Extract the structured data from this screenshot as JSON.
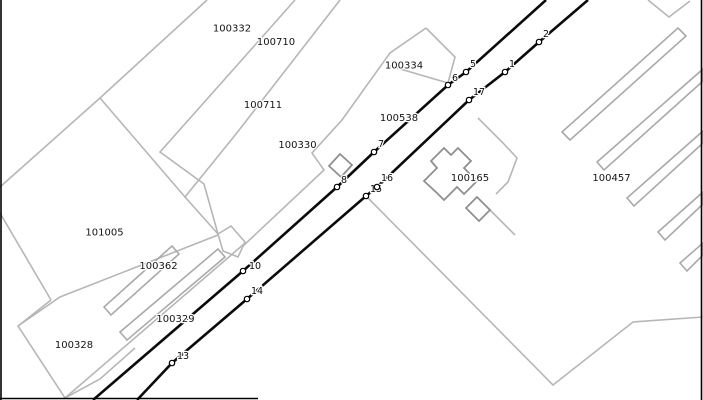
{
  "map": {
    "width": 703,
    "height": 400,
    "colors": {
      "background": "#ffffff",
      "parcel_line": "#b6b6b6",
      "strip_line": "#a9a9a9",
      "building_line": "#8f8f8f",
      "route_line": "#0b0b0b",
      "border": "#000000",
      "label_text": "#141414",
      "station_fill": "#ffffff",
      "station_stroke": "#000000",
      "halo": "#ffffff"
    },
    "parcel_labels": [
      {
        "text": "100332",
        "x": 232,
        "y": 28
      },
      {
        "text": "100710",
        "x": 276,
        "y": 41.5
      },
      {
        "text": "100711",
        "x": 263,
        "y": 104.5
      },
      {
        "text": "100330",
        "x": 297.5,
        "y": 144.5
      },
      {
        "text": "100334",
        "x": 404,
        "y": 65
      },
      {
        "text": "100538",
        "x": 399,
        "y": 117.5
      },
      {
        "text": "100165",
        "x": 470,
        "y": 177.5
      },
      {
        "text": "100457",
        "x": 611.5,
        "y": 177.5
      },
      {
        "text": "101005",
        "x": 104.5,
        "y": 232
      },
      {
        "text": "100362",
        "x": 158.5,
        "y": 265.5
      },
      {
        "text": "100329",
        "x": 175.5,
        "y": 318.5
      },
      {
        "text": "100328",
        "x": 74,
        "y": 344.5
      }
    ],
    "parcel_lines": [
      {
        "points": [
          [
            207,
            0
          ],
          [
            100,
            98
          ],
          [
            0,
            187
          ]
        ]
      },
      {
        "points": [
          [
            100,
            98
          ],
          [
            185,
            197
          ],
          [
            218,
            234
          ]
        ]
      },
      {
        "points": [
          [
            295,
            0
          ],
          [
            160,
            152
          ],
          [
            204,
            184
          ],
          [
            211,
            209
          ],
          [
            218,
            234
          ]
        ]
      },
      {
        "points": [
          [
            340,
            0
          ],
          [
            236,
            134
          ],
          [
            185,
            197
          ]
        ]
      },
      {
        "points": [
          [
            426,
            28
          ],
          [
            390,
            53
          ],
          [
            342,
            120
          ],
          [
            312,
            153
          ],
          [
            324,
            170
          ],
          [
            243,
            246
          ]
        ]
      },
      {
        "points": [
          [
            426,
            28
          ],
          [
            455,
            57
          ],
          [
            448,
            83
          ]
        ]
      },
      {
        "points": [
          [
            390,
            66
          ],
          [
            448,
            83
          ]
        ]
      },
      {
        "points": [
          [
            218,
            234
          ],
          [
            231,
            226
          ],
          [
            245,
            242
          ],
          [
            238,
            257
          ],
          [
            223,
            251
          ],
          [
            218,
            234
          ]
        ]
      },
      {
        "points": [
          [
            244,
            244
          ],
          [
            65,
            398
          ]
        ]
      },
      {
        "points": [
          [
            218,
            235
          ],
          [
            60,
            297
          ],
          [
            18,
            326
          ]
        ]
      },
      {
        "points": [
          [
            51,
            300
          ],
          [
            18,
            326
          ],
          [
            65,
            398
          ],
          [
            100,
            379
          ],
          [
            135,
            348
          ]
        ]
      },
      {
        "points": [
          [
            0,
            213
          ],
          [
            51,
            300
          ]
        ]
      },
      {
        "points": [
          [
            368,
            198
          ],
          [
            553,
            385
          ],
          [
            633,
            322
          ],
          [
            703,
            317
          ]
        ]
      },
      {
        "points": [
          [
            478,
            118
          ],
          [
            503,
            143
          ],
          [
            517,
            158
          ],
          [
            508,
            182
          ],
          [
            496,
            194
          ]
        ]
      },
      {
        "points": [
          [
            490,
            210
          ],
          [
            515,
            235
          ]
        ]
      },
      {
        "points": [
          [
            648,
            0
          ],
          [
            669,
            17
          ],
          [
            690,
            1
          ]
        ]
      }
    ],
    "strip_polygons": [
      {
        "points": [
          [
            562,
            132
          ],
          [
            678,
            28
          ],
          [
            686,
            36
          ],
          [
            570,
            140
          ]
        ]
      },
      {
        "points": [
          [
            597,
            162
          ],
          [
            703,
            69
          ],
          [
            703,
            81
          ],
          [
            604,
            170
          ]
        ]
      },
      {
        "points": [
          [
            627,
            198
          ],
          [
            703,
            131
          ],
          [
            703,
            143
          ],
          [
            634,
            206
          ]
        ]
      },
      {
        "points": [
          [
            658,
            232
          ],
          [
            703,
            192
          ],
          [
            703,
            204
          ],
          [
            665,
            240
          ]
        ]
      },
      {
        "points": [
          [
            680,
            263
          ],
          [
            703,
            243
          ],
          [
            703,
            255
          ],
          [
            687,
            271
          ]
        ]
      },
      {
        "points": [
          [
            104,
            307
          ],
          [
            172,
            246
          ],
          [
            179,
            254
          ],
          [
            111,
            315
          ]
        ]
      },
      {
        "points": [
          [
            120,
            332
          ],
          [
            218,
            249
          ],
          [
            225,
            257
          ],
          [
            127,
            340
          ]
        ]
      }
    ],
    "building_polygons": [
      {
        "points": [
          [
            424,
            181
          ],
          [
            437,
            168
          ],
          [
            431,
            161
          ],
          [
            444,
            148
          ],
          [
            451,
            155
          ],
          [
            458,
            148
          ],
          [
            471,
            161
          ],
          [
            464,
            168
          ],
          [
            477,
            181
          ],
          [
            464,
            194
          ],
          [
            457,
            187
          ],
          [
            444,
            200
          ],
          [
            437,
            193
          ]
        ]
      },
      {
        "points": [
          [
            466,
            208
          ],
          [
            477,
            197
          ],
          [
            490,
            210
          ],
          [
            479,
            221
          ]
        ]
      },
      {
        "points": [
          [
            329,
            166
          ],
          [
            340,
            154
          ],
          [
            352,
            165
          ],
          [
            341,
            177
          ]
        ]
      }
    ],
    "routes": [
      {
        "name": "route-a",
        "points": [
          [
            93,
            400
          ],
          [
            243,
            271
          ],
          [
            337,
            187
          ],
          [
            374,
            152
          ],
          [
            448,
            85
          ],
          [
            466,
            72
          ],
          [
            546,
            0
          ]
        ]
      },
      {
        "name": "route-b",
        "points": [
          [
            137,
            400
          ],
          [
            172,
            363
          ],
          [
            247,
            299
          ],
          [
            366,
            196
          ],
          [
            377,
            187
          ],
          [
            469,
            100
          ],
          [
            505,
            72
          ],
          [
            539,
            42
          ],
          [
            588,
            0
          ]
        ]
      }
    ],
    "stations": [
      {
        "label": "10",
        "x": 243,
        "y": 271,
        "dx": 6,
        "dy": -2
      },
      {
        "label": "8",
        "x": 337,
        "y": 187,
        "dx": 4,
        "dy": -4
      },
      {
        "label": "7",
        "x": 374,
        "y": 152,
        "dx": 4,
        "dy": -5
      },
      {
        "label": "6",
        "x": 448,
        "y": 85,
        "dx": 4,
        "dy": -4
      },
      {
        "label": "5",
        "x": 466,
        "y": 72,
        "dx": 4,
        "dy": -5
      },
      {
        "label": "13",
        "x": 172,
        "y": 363,
        "dx": 5,
        "dy": -4
      },
      {
        "label": "14",
        "x": 247,
        "y": 299,
        "dx": 4,
        "dy": -5
      },
      {
        "label": "15",
        "x": 366,
        "y": 196,
        "dx": 4,
        "dy": -4
      },
      {
        "label": "16",
        "x": 377,
        "y": 187,
        "dx": 4,
        "dy": -6
      },
      {
        "label": "17",
        "x": 469,
        "y": 100,
        "dx": 4,
        "dy": -5
      },
      {
        "label": "1",
        "x": 505,
        "y": 72,
        "dx": 4,
        "dy": -5
      },
      {
        "label": "2",
        "x": 539,
        "y": 42,
        "dx": 4,
        "dy": -5
      }
    ],
    "borders": [
      {
        "name": "border-left",
        "points": [
          [
            1,
            0
          ],
          [
            1,
            400
          ]
        ]
      },
      {
        "name": "border-right",
        "points": [
          [
            701.5,
            0
          ],
          [
            701.5,
            400
          ]
        ]
      },
      {
        "name": "border-bottom-partial",
        "points": [
          [
            0,
            398.5
          ],
          [
            258,
            398.5
          ]
        ]
      }
    ]
  }
}
